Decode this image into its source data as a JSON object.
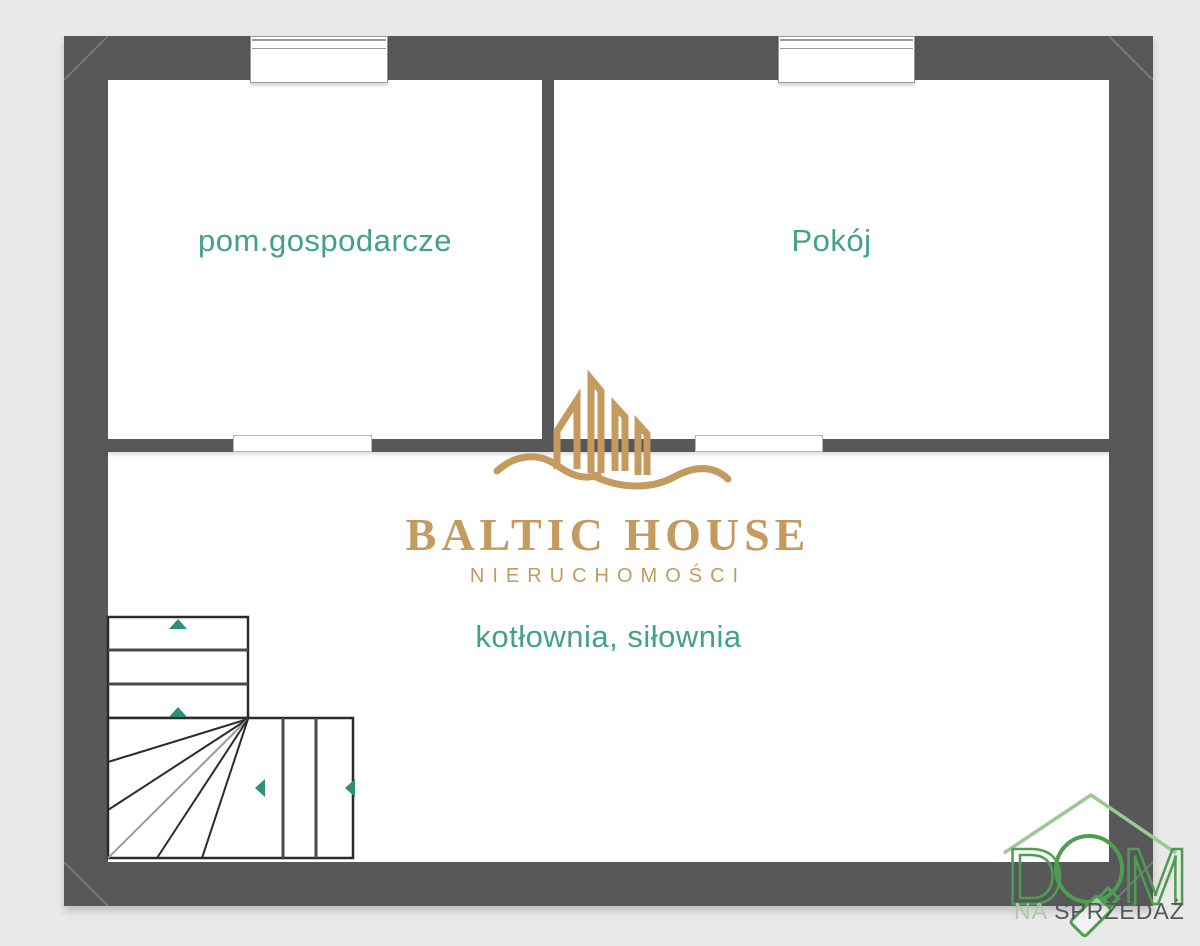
{
  "page": {
    "background": "#e9e9e9",
    "type_note": "architectural floor plan"
  },
  "colors": {
    "wall": "#58585a",
    "room_fill": "#ffffff",
    "room_label_teal": "#43a08c",
    "brand_gold": "#c49a5f",
    "logo_green": "#4d9e50",
    "roof_light_green": "#9cc894",
    "subtitle_gray": "#55565a",
    "stair_arrow_teal": "#2e8f79"
  },
  "floor_plan": {
    "rooms": [
      {
        "label": "pom.gospodarcze"
      },
      {
        "label": "Pokój"
      },
      {
        "label": "kotłownia, siłownia"
      }
    ]
  },
  "watermark_logo": {
    "brand": "BALTIC HOUSE",
    "tagline": "NIERUCHOMOŚCI"
  },
  "corner_logo": {
    "word": "DOM",
    "letter_d": "D",
    "letter_m": "M",
    "subtitle_prefix": "NA",
    "subtitle_main": "SPRZEDAŻ"
  }
}
